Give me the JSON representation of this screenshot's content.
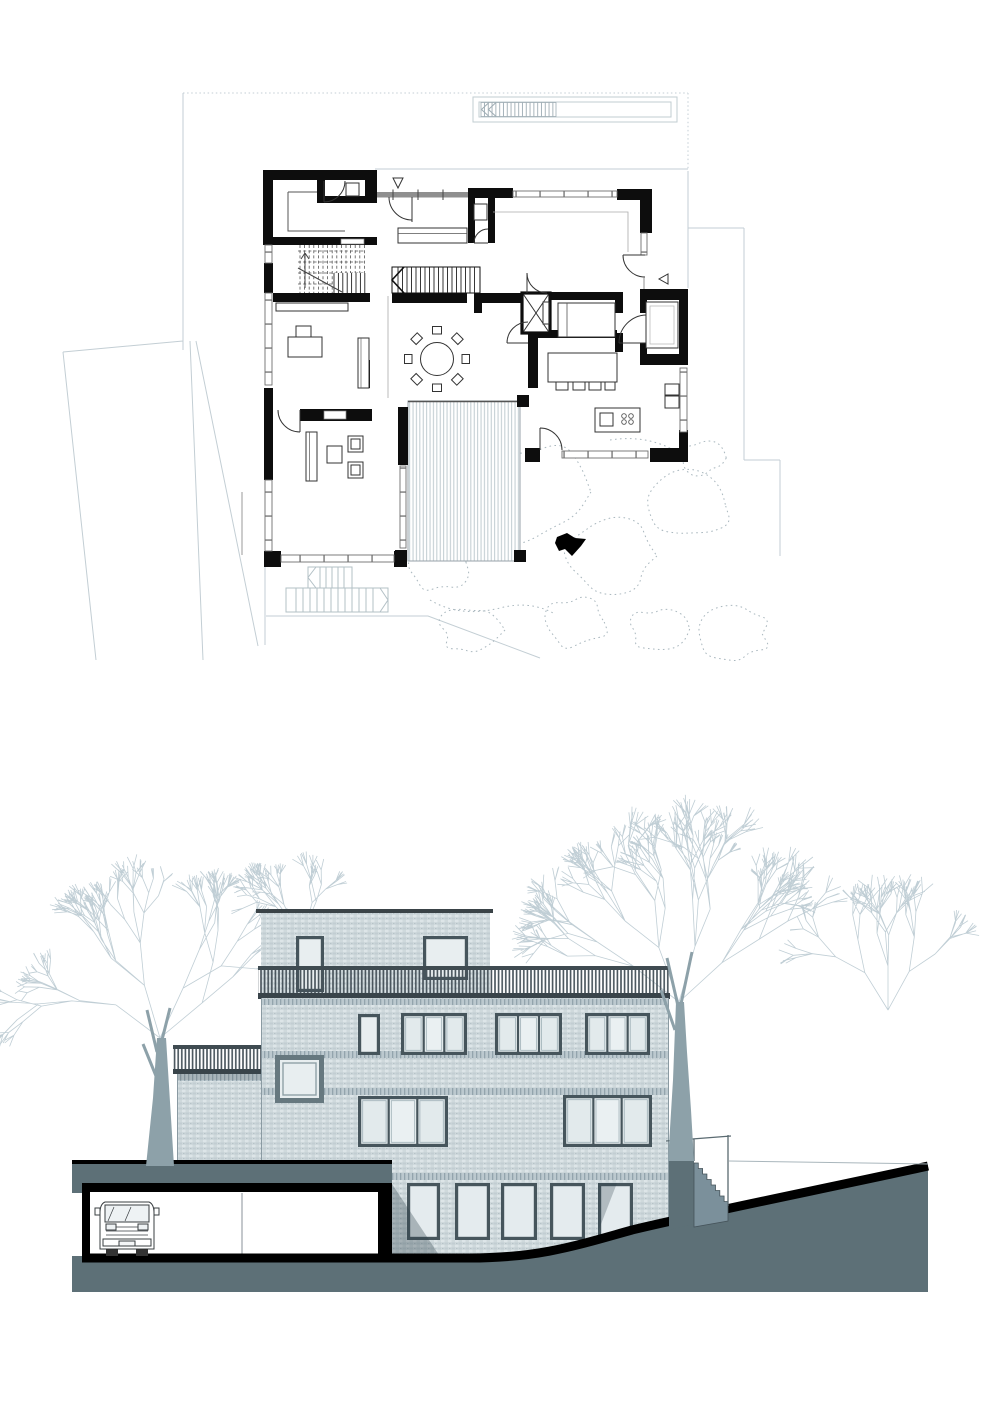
{
  "document": {
    "kind": "architectural-drawing-sheet",
    "views": [
      "ground-floor-plan",
      "street-elevation-section"
    ],
    "visible_text": ""
  },
  "palette": {
    "paper": "#ffffff",
    "ink": "#0d0d0d",
    "light_line": "#c3ced4",
    "dotted_line": "#a9b7be",
    "earth_section": "#5d7077",
    "brick_base": "#cfd9dc",
    "window_frame": "#46555c",
    "glass": "#e8eef0",
    "railing": "#46525a",
    "tree_trunk": "#8da1a9",
    "tree_canopy": "#bdcbd3"
  },
  "floor_plan": {
    "markers": {
      "entrance_triangle": "down",
      "side_entrance_triangle": "left"
    },
    "dining_table": {
      "shape": "round",
      "chairs": 8,
      "cx": 437,
      "cy": 359,
      "radius": 16.5,
      "chair_radius": 25.5
    },
    "kitchen": {
      "island_stools": 4,
      "hob_burners": 4
    },
    "counts": {
      "stair_flights": 3,
      "elevator": 1,
      "terrace_decks": 1,
      "exterior_stairs": 2
    },
    "tree_canopies": [
      {
        "cx": 520,
        "cy": 492,
        "r": 66,
        "seed": 11
      },
      {
        "cx": 438,
        "cy": 562,
        "r": 38,
        "seed": 21
      },
      {
        "cx": 612,
        "cy": 556,
        "r": 46,
        "seed": 31
      },
      {
        "cx": 690,
        "cy": 506,
        "r": 40,
        "seed": 41
      },
      {
        "cx": 736,
        "cy": 634,
        "r": 36,
        "seed": 51
      },
      {
        "cx": 659,
        "cy": 629,
        "r": 28,
        "seed": 61
      },
      {
        "cx": 578,
        "cy": 622,
        "r": 33,
        "seed": 71
      },
      {
        "cx": 702,
        "cy": 458,
        "r": 22,
        "seed": 81
      },
      {
        "cx": 470,
        "cy": 630,
        "r": 30,
        "seed": 91
      }
    ]
  },
  "elevation": {
    "floors_visible": 4,
    "garage": {
      "vans": 1
    },
    "windows": [
      {
        "name": "penthouse-door",
        "x": 296,
        "y": 236,
        "w": 28,
        "h": 56,
        "panes": 1,
        "style": "std"
      },
      {
        "name": "penthouse-window",
        "x": 423,
        "y": 236,
        "w": 45,
        "h": 44,
        "panes": 1,
        "style": "std"
      },
      {
        "name": "upper-small",
        "x": 358,
        "y": 314,
        "w": 22,
        "h": 41,
        "panes": 1,
        "style": "std"
      },
      {
        "name": "upper-left",
        "x": 401,
        "y": 313,
        "w": 66,
        "h": 42,
        "panes": 3,
        "style": "std"
      },
      {
        "name": "upper-mid",
        "x": 495,
        "y": 313,
        "w": 67,
        "h": 42,
        "panes": 3,
        "style": "std"
      },
      {
        "name": "upper-right",
        "x": 585,
        "y": 313,
        "w": 65,
        "h": 42,
        "panes": 3,
        "style": "std"
      },
      {
        "name": "square-window",
        "x": 275,
        "y": 355,
        "w": 49,
        "h": 48,
        "panes": 1,
        "style": "bold"
      },
      {
        "name": "middle-left",
        "x": 358,
        "y": 396,
        "w": 90,
        "h": 51,
        "panes": 3,
        "style": "std"
      },
      {
        "name": "middle-right",
        "x": 563,
        "y": 395,
        "w": 89,
        "h": 52,
        "panes": 3,
        "style": "std"
      },
      {
        "name": "basement-1",
        "x": 407,
        "y": 483,
        "w": 33,
        "h": 57,
        "panes": 1,
        "style": "bsm"
      },
      {
        "name": "basement-2",
        "x": 455,
        "y": 483,
        "w": 35,
        "h": 57,
        "panes": 1,
        "style": "bsm"
      },
      {
        "name": "basement-3",
        "x": 501,
        "y": 483,
        "w": 36,
        "h": 57,
        "panes": 1,
        "style": "bsm"
      },
      {
        "name": "basement-4",
        "x": 550,
        "y": 483,
        "w": 35,
        "h": 57,
        "panes": 1,
        "style": "bsm"
      },
      {
        "name": "basement-5",
        "x": 598,
        "y": 483,
        "w": 35,
        "h": 57,
        "panes": 1,
        "style": "bsm"
      }
    ],
    "trees": [
      {
        "x": 160,
        "y": 338,
        "len": 55,
        "depth": 5,
        "k": 4,
        "seed": 7
      },
      {
        "x": 679,
        "y": 302,
        "len": 58,
        "depth": 5,
        "k": 4,
        "seed": 17
      },
      {
        "x": 888,
        "y": 310,
        "len": 44,
        "depth": 4,
        "k": 3,
        "seed": 27
      },
      {
        "x": 300,
        "y": 260,
        "len": 34,
        "depth": 4,
        "k": 2,
        "seed": 37
      }
    ],
    "trunks": [
      {
        "name": "left-tree-trunk",
        "points": "146,466 153,398 157,338 166,338 170,402 174,466",
        "branches": "M157,352 L147,310 M160,348 L170,308 M156,376 L143,344"
      },
      {
        "name": "right-tree-trunk",
        "points": "668,461 673,380 676,302 684,302 687,352 691,410 694,461",
        "branches": "M678,306 L667,258 M681,304 L692,252 M675,330 L661,290"
      }
    ]
  }
}
